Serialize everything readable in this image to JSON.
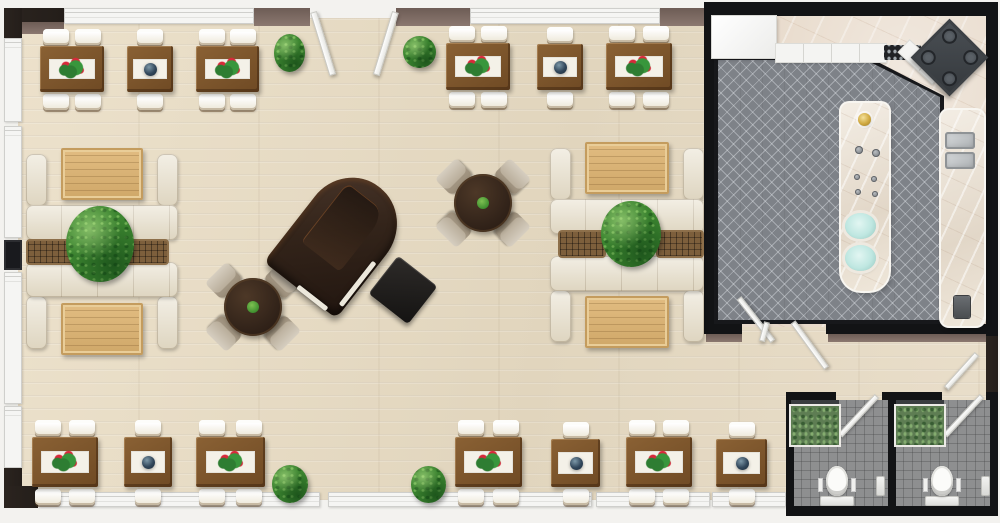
{
  "meta": {
    "title": "3D restaurant floor plan",
    "canvas": {
      "w": 1000,
      "h": 523
    }
  },
  "palette": {
    "wood_floor": "#e7dcc5",
    "wall_dark": "#241e1a",
    "wall_black": "#121315",
    "wall_mauve": "#8b7870",
    "window": "#f5f5f3",
    "table_wood": "#6f4a24",
    "sofa_cream": "#e9e2d0",
    "lounge_wood": "#d9b57c",
    "plant_green": "#3c8530",
    "rug_gray": "#7e8288",
    "marble": "#e7d9c9",
    "tile_gray": "#8e8f90",
    "flower_red": "#d8293a",
    "teal": "#bfe7e1",
    "gold": "#cfa83f",
    "piano_brown": "#33241a"
  },
  "rooms": [
    {
      "name": "dining-lounge",
      "floor": "light wood"
    },
    {
      "name": "kitchen",
      "floor": "gray herringbone with marble border"
    },
    {
      "name": "restroom-left",
      "floor": "gray tile"
    },
    {
      "name": "restroom-right",
      "floor": "gray tile"
    }
  ],
  "items": [
    {
      "t": "floor-wood",
      "name": "dining-floor",
      "x": 18,
      "y": 18,
      "w": 972,
      "h": 482
    },
    {
      "t": "floor-kitchen",
      "name": "kitchen-floor",
      "x": 710,
      "y": 12,
      "w": 278,
      "h": 315
    },
    {
      "t": "kitchen-rug",
      "name": "kitchen-rug",
      "x": 714,
      "y": 56,
      "w": 230,
      "h": 268
    },
    {
      "t": "floor-restroom",
      "name": "restroom-floor-left",
      "x": 792,
      "y": 400,
      "w": 98,
      "h": 107
    },
    {
      "t": "floor-restroom",
      "name": "restroom-floor-right",
      "x": 894,
      "y": 400,
      "w": 97,
      "h": 107
    },
    {
      "t": "wall",
      "v": "dark",
      "x": 4,
      "y": 8,
      "w": 60,
      "h": 16
    },
    {
      "t": "wall",
      "v": "mauve",
      "x": 4,
      "y": 22,
      "w": 60,
      "h": 12
    },
    {
      "t": "wall",
      "v": "win",
      "x": 64,
      "y": 8,
      "w": 190,
      "h": 16
    },
    {
      "t": "wall",
      "v": "mauve",
      "x": 254,
      "y": 8,
      "w": 56,
      "h": 18
    },
    {
      "t": "wall",
      "v": "mauve",
      "x": 396,
      "y": 8,
      "w": 74,
      "h": 18
    },
    {
      "t": "wall",
      "v": "win",
      "x": 470,
      "y": 8,
      "w": 190,
      "h": 16
    },
    {
      "t": "wall",
      "v": "mauve",
      "x": 660,
      "y": 8,
      "w": 50,
      "h": 18
    },
    {
      "t": "wall",
      "v": "dark",
      "x": 4,
      "y": 8,
      "w": 18,
      "h": 30
    },
    {
      "t": "wall",
      "v": "win",
      "x": 4,
      "y": 38,
      "w": 18,
      "h": 84
    },
    {
      "t": "wall",
      "v": "win",
      "x": 4,
      "y": 126,
      "w": 18,
      "h": 112
    },
    {
      "t": "wall",
      "v": "darkwin",
      "x": 4,
      "y": 240,
      "w": 18,
      "h": 30
    },
    {
      "t": "wall",
      "v": "win",
      "x": 4,
      "y": 272,
      "w": 18,
      "h": 132
    },
    {
      "t": "wall",
      "v": "win",
      "x": 4,
      "y": 406,
      "w": 18,
      "h": 62
    },
    {
      "t": "wall",
      "v": "dark",
      "x": 4,
      "y": 468,
      "w": 18,
      "h": 36
    },
    {
      "t": "wall",
      "v": "dark",
      "x": 4,
      "y": 486,
      "w": 34,
      "h": 22
    },
    {
      "t": "wall",
      "v": "win",
      "x": 38,
      "y": 492,
      "w": 282,
      "h": 15
    },
    {
      "t": "wall",
      "v": "win",
      "x": 328,
      "y": 492,
      "w": 264,
      "h": 15
    },
    {
      "t": "wall",
      "v": "win",
      "x": 596,
      "y": 492,
      "w": 114,
      "h": 15
    },
    {
      "t": "wall",
      "v": "win",
      "x": 712,
      "y": 492,
      "w": 74,
      "h": 15
    },
    {
      "t": "wall",
      "v": "black",
      "x": 704,
      "y": 2,
      "w": 294,
      "h": 14
    },
    {
      "t": "wall",
      "v": "black",
      "x": 704,
      "y": 2,
      "w": 10,
      "h": 332
    },
    {
      "t": "wall",
      "v": "black",
      "x": 986,
      "y": 2,
      "w": 12,
      "h": 334
    },
    {
      "t": "wall",
      "v": "black",
      "x": 704,
      "y": 324,
      "w": 38,
      "h": 10
    },
    {
      "t": "wall",
      "v": "black",
      "x": 826,
      "y": 324,
      "w": 172,
      "h": 10
    },
    {
      "t": "wall",
      "v": "mauve",
      "x": 706,
      "y": 334,
      "w": 36,
      "h": 8
    },
    {
      "t": "wall",
      "v": "mauve",
      "x": 828,
      "y": 334,
      "w": 158,
      "h": 8
    },
    {
      "t": "wall",
      "v": "dark",
      "x": 986,
      "y": 336,
      "w": 12,
      "h": 60
    },
    {
      "t": "wall",
      "v": "black",
      "x": 786,
      "y": 392,
      "w": 50,
      "h": 8
    },
    {
      "t": "wall",
      "v": "black",
      "x": 882,
      "y": 392,
      "w": 60,
      "h": 8
    },
    {
      "t": "wall",
      "v": "black",
      "x": 986,
      "y": 392,
      "w": 12,
      "h": 8
    },
    {
      "t": "wall",
      "v": "black",
      "x": 786,
      "y": 392,
      "w": 8,
      "h": 122
    },
    {
      "t": "wall",
      "v": "black",
      "x": 888,
      "y": 392,
      "w": 8,
      "h": 122
    },
    {
      "t": "wall",
      "v": "black",
      "x": 990,
      "y": 392,
      "w": 8,
      "h": 122
    },
    {
      "t": "wall",
      "v": "black",
      "x": 786,
      "y": 506,
      "w": 212,
      "h": 10
    },
    {
      "t": "door-leaf",
      "name": "entrance-door-left",
      "x": 310,
      "y": 12,
      "w": 7,
      "h": 66,
      "rot": -17
    },
    {
      "t": "door-leaf",
      "name": "entrance-door-right",
      "x": 392,
      "y": 12,
      "w": 7,
      "h": 66,
      "rot": 17
    },
    {
      "t": "door-leaf",
      "name": "kitchen-door-left",
      "x": 736,
      "y": 298,
      "w": 6,
      "h": 55,
      "rot": -38
    },
    {
      "t": "door-leaf",
      "name": "kitchen-door-stub",
      "x": 764,
      "y": 322,
      "w": 6,
      "h": 20,
      "rot": 15
    },
    {
      "t": "door-leaf",
      "name": "kitchen-door-right",
      "x": 790,
      "y": 322,
      "w": 6,
      "h": 57,
      "rot": -36
    },
    {
      "t": "door-leaf",
      "name": "corridor-door",
      "x": 974,
      "y": 354,
      "w": 6,
      "h": 46,
      "rot": 42
    },
    {
      "t": "door-leaf",
      "name": "restroom-door-left",
      "x": 874,
      "y": 396,
      "w": 6,
      "h": 54,
      "rot": 43
    },
    {
      "t": "door-leaf",
      "name": "restroom-door-right",
      "x": 979,
      "y": 396,
      "w": 6,
      "h": 54,
      "rot": 43
    },
    {
      "t": "fridge",
      "name": "kitchen-cabinet-block",
      "x": 712,
      "y": 16,
      "w": 64,
      "h": 42
    },
    {
      "t": "counter-white",
      "name": "kitchen-counter",
      "x": 776,
      "y": 44,
      "w": 110,
      "h": 18
    },
    {
      "t": "cooktop",
      "name": "cooktop",
      "x": 884,
      "y": 45,
      "w": 37,
      "h": 15
    },
    {
      "t": "counter-white",
      "name": "corner-cabinet",
      "x": 898,
      "y": 54,
      "w": 46,
      "h": 16,
      "rot": 43
    },
    {
      "t": "stove",
      "name": "corner-stove",
      "x": 922,
      "y": 30,
      "w": 55,
      "h": 55,
      "rot": 45
    },
    {
      "t": "island",
      "name": "kitchen-island",
      "x": 841,
      "y": 103,
      "w": 48,
      "h": 188
    },
    {
      "t": "faucet",
      "name": "island-faucet",
      "x": 858,
      "y": 113,
      "w": 13,
      "h": 13
    },
    {
      "t": "knob",
      "name": "island-knob",
      "x": 855,
      "y": 146,
      "w": 8,
      "h": 8
    },
    {
      "t": "knob",
      "name": "island-knob",
      "x": 872,
      "y": 149,
      "w": 8,
      "h": 8
    },
    {
      "t": "knob",
      "name": "island-knob",
      "x": 854,
      "y": 174,
      "w": 6,
      "h": 6
    },
    {
      "t": "knob",
      "name": "island-knob",
      "x": 871,
      "y": 176,
      "w": 6,
      "h": 6
    },
    {
      "t": "knob",
      "name": "island-knob",
      "x": 855,
      "y": 189,
      "w": 6,
      "h": 6
    },
    {
      "t": "knob",
      "name": "island-knob",
      "x": 872,
      "y": 191,
      "w": 6,
      "h": 6
    },
    {
      "t": "basin-teal",
      "name": "island-basin",
      "x": 845,
      "y": 213,
      "w": 31,
      "h": 26
    },
    {
      "t": "basin-teal",
      "name": "island-basin",
      "x": 845,
      "y": 245,
      "w": 31,
      "h": 26
    },
    {
      "t": "right-counter",
      "name": "sink-counter",
      "x": 941,
      "y": 110,
      "w": 43,
      "h": 216
    },
    {
      "t": "sink-steel",
      "name": "sink-basin",
      "x": 945,
      "y": 132,
      "w": 30,
      "h": 17
    },
    {
      "t": "sink-steel",
      "name": "sink-basin",
      "x": 945,
      "y": 152,
      "w": 30,
      "h": 17
    },
    {
      "t": "small-appliance",
      "name": "counter-appliance",
      "x": 954,
      "y": 296,
      "w": 16,
      "h": 22
    },
    {
      "t": "wc-plant",
      "name": "restroom-vanity-left",
      "x": 791,
      "y": 400,
      "w": 48,
      "h": 45
    },
    {
      "t": "wc-plant",
      "name": "restroom-vanity-right",
      "x": 896,
      "y": 400,
      "w": 48,
      "h": 45
    },
    {
      "t": "toilet",
      "name": "toilet-left",
      "x": 818,
      "y": 466,
      "w": 38,
      "h": 40
    },
    {
      "t": "toilet",
      "name": "toilet-right",
      "x": 923,
      "y": 466,
      "w": 38,
      "h": 40
    },
    {
      "t": "wall-fixture",
      "name": "restroom-fixture",
      "x": 876,
      "y": 476,
      "w": 9,
      "h": 20
    },
    {
      "t": "wall-fixture",
      "name": "restroom-fixture",
      "x": 981,
      "y": 476,
      "w": 9,
      "h": 20
    },
    {
      "t": "booth",
      "name": "lounge-booth",
      "x": 26,
      "y": 148,
      "w": 152,
      "h": 92,
      "flip": 0
    },
    {
      "t": "booth",
      "name": "lounge-booth",
      "x": 26,
      "y": 262,
      "w": 152,
      "h": 93,
      "flip": 1
    },
    {
      "t": "booth",
      "name": "lounge-booth",
      "x": 550,
      "y": 142,
      "w": 154,
      "h": 92,
      "flip": 0
    },
    {
      "t": "booth",
      "name": "lounge-booth",
      "x": 550,
      "y": 256,
      "w": 154,
      "h": 92,
      "flip": 1
    },
    {
      "t": "slat-table",
      "name": "coffee-table",
      "x": 28,
      "y": 241,
      "w": 46,
      "h": 22
    },
    {
      "t": "slat-table",
      "name": "coffee-table",
      "x": 121,
      "y": 241,
      "w": 46,
      "h": 22
    },
    {
      "t": "slat-table",
      "name": "coffee-table",
      "x": 560,
      "y": 232,
      "w": 44,
      "h": 24
    },
    {
      "t": "slat-table",
      "name": "coffee-table",
      "x": 658,
      "y": 232,
      "w": 44,
      "h": 24
    },
    {
      "t": "plant",
      "name": "lounge-plant",
      "x": 66,
      "y": 206,
      "w": 68,
      "h": 76
    },
    {
      "t": "plant",
      "name": "lounge-plant",
      "x": 601,
      "y": 201,
      "w": 60,
      "h": 66
    },
    {
      "t": "plant",
      "name": "floor-plant",
      "x": 274,
      "y": 34,
      "w": 31,
      "h": 38
    },
    {
      "t": "plant",
      "name": "floor-plant",
      "x": 403,
      "y": 36,
      "w": 33,
      "h": 32
    },
    {
      "t": "plant",
      "name": "floor-plant",
      "x": 272,
      "y": 465,
      "w": 36,
      "h": 38
    },
    {
      "t": "plant",
      "name": "floor-plant",
      "x": 411,
      "y": 466,
      "w": 35,
      "h": 37
    },
    {
      "t": "round-table",
      "name": "round-dining-table",
      "x": 207,
      "y": 261,
      "w": 92,
      "h": 92
    },
    {
      "t": "round-table",
      "name": "round-dining-table",
      "x": 437,
      "y": 157,
      "w": 92,
      "h": 92
    },
    {
      "t": "piano",
      "name": "grand-piano",
      "x": 294,
      "y": 174,
      "w": 92,
      "h": 130,
      "rot": 38
    },
    {
      "t": "piano-bench",
      "name": "piano-bench",
      "x": 378,
      "y": 266,
      "w": 50,
      "h": 48,
      "rot": 38
    },
    {
      "t": "rect-table",
      "name": "dining-table",
      "x": 40,
      "y": 46,
      "w": 64,
      "h": 46,
      "seats": 4,
      "c": "f"
    },
    {
      "t": "rect-table",
      "name": "dining-table",
      "x": 127,
      "y": 46,
      "w": 46,
      "h": 46,
      "seats": 2,
      "c": "v"
    },
    {
      "t": "rect-table",
      "name": "dining-table",
      "x": 196,
      "y": 46,
      "w": 63,
      "h": 46,
      "seats": 4,
      "c": "f"
    },
    {
      "t": "rect-table",
      "name": "dining-table",
      "x": 446,
      "y": 43,
      "w": 64,
      "h": 47,
      "seats": 4,
      "c": "f"
    },
    {
      "t": "rect-table",
      "name": "dining-table",
      "x": 537,
      "y": 44,
      "w": 46,
      "h": 46,
      "seats": 2,
      "c": "v"
    },
    {
      "t": "rect-table",
      "name": "dining-table",
      "x": 606,
      "y": 43,
      "w": 66,
      "h": 47,
      "seats": 4,
      "c": "f"
    },
    {
      "t": "rect-table",
      "name": "dining-table",
      "x": 32,
      "y": 437,
      "w": 66,
      "h": 50,
      "seats": 4,
      "c": "f"
    },
    {
      "t": "rect-table",
      "name": "dining-table",
      "x": 124,
      "y": 437,
      "w": 48,
      "h": 50,
      "seats": 2,
      "c": "v"
    },
    {
      "t": "rect-table",
      "name": "dining-table",
      "x": 196,
      "y": 437,
      "w": 69,
      "h": 50,
      "seats": 4,
      "c": "f"
    },
    {
      "t": "rect-table",
      "name": "dining-table",
      "x": 455,
      "y": 437,
      "w": 67,
      "h": 50,
      "seats": 4,
      "c": "f"
    },
    {
      "t": "rect-table",
      "name": "dining-table",
      "x": 551,
      "y": 439,
      "w": 49,
      "h": 48,
      "seats": 2,
      "c": "v"
    },
    {
      "t": "rect-table",
      "name": "dining-table",
      "x": 626,
      "y": 437,
      "w": 66,
      "h": 50,
      "seats": 4,
      "c": "f"
    },
    {
      "t": "rect-table",
      "name": "dining-table",
      "x": 716,
      "y": 439,
      "w": 51,
      "h": 48,
      "seats": 2,
      "c": "v"
    }
  ]
}
